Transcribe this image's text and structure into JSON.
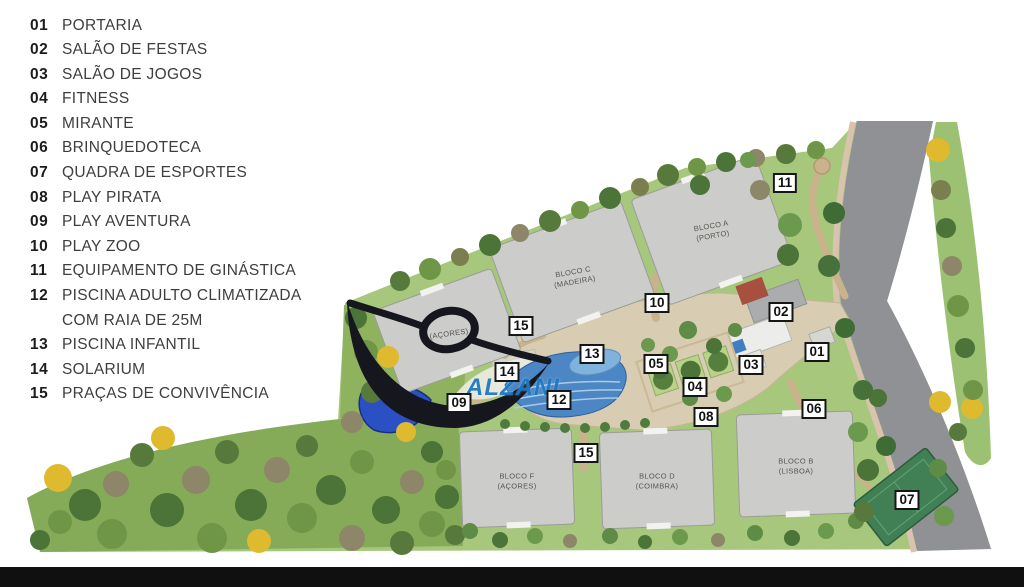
{
  "legend": {
    "items": [
      {
        "num": "01",
        "label": "PORTARIA"
      },
      {
        "num": "02",
        "label": "SALÃO DE FESTAS"
      },
      {
        "num": "03",
        "label": "SALÃO DE JOGOS"
      },
      {
        "num": "04",
        "label": "FITNESS"
      },
      {
        "num": "05",
        "label": "MIRANTE"
      },
      {
        "num": "06",
        "label": "BRINQUEDOTECA"
      },
      {
        "num": "07",
        "label": "QUADRA DE ESPORTES"
      },
      {
        "num": "08",
        "label": "PLAY PIRATA"
      },
      {
        "num": "09",
        "label": "PLAY AVENTURA"
      },
      {
        "num": "10",
        "label": "PLAY ZOO"
      },
      {
        "num": "11",
        "label": "EQUIPAMENTO DE GINÁSTICA"
      },
      {
        "num": "12",
        "label": "PISCINA ADULTO CLIMATIZADA",
        "label2": "COM RAIA DE 25M"
      },
      {
        "num": "13",
        "label": "PISCINA INFANTIL"
      },
      {
        "num": "14",
        "label": "SOLARIUM"
      },
      {
        "num": "15",
        "label": "PRAÇAS DE CONVIVÊNCIA"
      }
    ]
  },
  "map": {
    "buildings": [
      {
        "id": "bloco-a",
        "line1": "BLOCO A",
        "line2": "(PORTO)"
      },
      {
        "id": "bloco-c",
        "line1": "BLOCO C",
        "line2": "(MADEIRA)"
      },
      {
        "id": "bloco-e",
        "line1": "",
        "line2": "(AÇORES)"
      },
      {
        "id": "bloco-f",
        "line1": "BLOCO F",
        "line2": "(AÇORES)"
      },
      {
        "id": "bloco-d",
        "line1": "BLOCO D",
        "line2": "(COIMBRA)"
      },
      {
        "id": "bloco-b",
        "line1": "BLOCO B",
        "line2": "(LISBOA)"
      }
    ],
    "markers": [
      {
        "num": "11"
      },
      {
        "num": "10"
      },
      {
        "num": "02"
      },
      {
        "num": "15"
      },
      {
        "num": "01"
      },
      {
        "num": "13"
      },
      {
        "num": "05"
      },
      {
        "num": "03"
      },
      {
        "num": "14"
      },
      {
        "num": "04"
      },
      {
        "num": "12"
      },
      {
        "num": "09"
      },
      {
        "num": "06"
      },
      {
        "num": "08"
      },
      {
        "num": "15"
      },
      {
        "num": "07"
      }
    ]
  },
  "watermark": {
    "text": "ALZANI"
  },
  "colors": {
    "watermark_blue": "#1e79c4",
    "pool_blue": "#4d86c4",
    "court_green": "#417f54",
    "road_gray": "#8f9194",
    "swoosh_black": "#16161e"
  }
}
